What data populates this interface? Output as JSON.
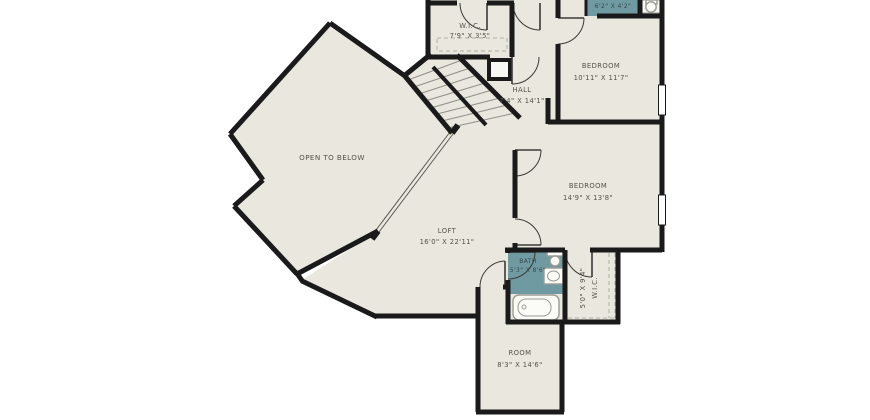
{
  "colors": {
    "background": "#ffffff",
    "floor": "#e9e7de",
    "wall": "#1a1a1a",
    "bath_floor": "#6f9aa1",
    "label_text": "#55544b"
  },
  "rooms": {
    "wic_top": {
      "name": "W.I.C.",
      "dims": "7'9\" X 3'5\""
    },
    "bath_top": {
      "dims": "6'2\" X 4'2\""
    },
    "bedroom_1": {
      "name": "BEDROOM",
      "dims": "10'11\" X 11'7\""
    },
    "hall": {
      "name": "HALL",
      "dims": "7'4\" X 14'1\""
    },
    "open_to_below": {
      "name": "OPEN TO BELOW"
    },
    "loft": {
      "name": "LOFT",
      "dims": "16'0\" X 22'11\""
    },
    "bedroom_2": {
      "name": "BEDROOM",
      "dims": "14'9\" X 13'8\""
    },
    "bath_2": {
      "name": "BATH",
      "dims": "5'3\" X 8'6\""
    },
    "wic_2": {
      "name": "W.I.C.",
      "dims": "5'0\" X 9'4\""
    },
    "room": {
      "name": "ROOM",
      "dims": "8'3\" X 14'6\""
    }
  }
}
